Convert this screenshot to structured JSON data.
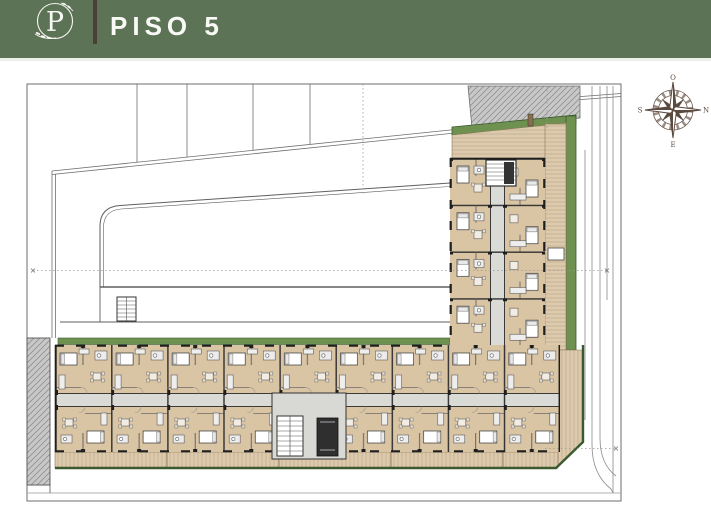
{
  "header": {
    "title": "PISO 5",
    "logo_letter": "P"
  },
  "compass": {
    "top": "O",
    "right": "N",
    "left": "S",
    "bottom": "E"
  },
  "colors": {
    "header_green": "#5d7355",
    "header_divider": "#4a4035",
    "floor_tan": "#d9c4a4",
    "terrace_tan": "#ddc9ab",
    "planter_green": "#6f9150",
    "planter_green_dark": "#3c5a30",
    "corridor_gray": "#dadad6",
    "wall_dark": "#2b2b2b",
    "hatch_gray": "#c8c8c8",
    "drawing_line": "#6e6e6e",
    "compass_brown": "#5b4a3f"
  }
}
